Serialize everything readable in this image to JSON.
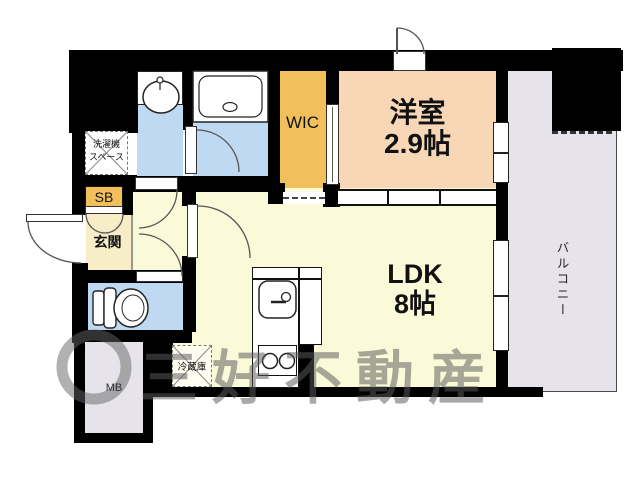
{
  "rooms": {
    "western_room": {
      "name": "洋室",
      "size": "2.9帖"
    },
    "ldk": {
      "name": "LDK",
      "size": "8帖"
    },
    "wic": {
      "label": "WIC"
    },
    "balcony": {
      "label": "バルコニー"
    },
    "entrance": {
      "label": "玄関"
    },
    "shoe_box": {
      "label": "SB"
    },
    "meter_box": {
      "label": "MB"
    },
    "laundry_space": {
      "line1": "洗濯機",
      "line2": "スペース"
    },
    "refrigerator": {
      "label": "冷蔵庫"
    }
  },
  "watermark": {
    "text": "三好不動産"
  },
  "colors": {
    "wall": "#000000",
    "western_room": "#F8D7B6",
    "wic": "#F2C05A",
    "ldk": "#FAFAD8",
    "entrance": "#F7EEC8",
    "wet_area": "#BFD9F2",
    "balcony": "#E6E4EA",
    "watermark": "#5A5A5A"
  }
}
